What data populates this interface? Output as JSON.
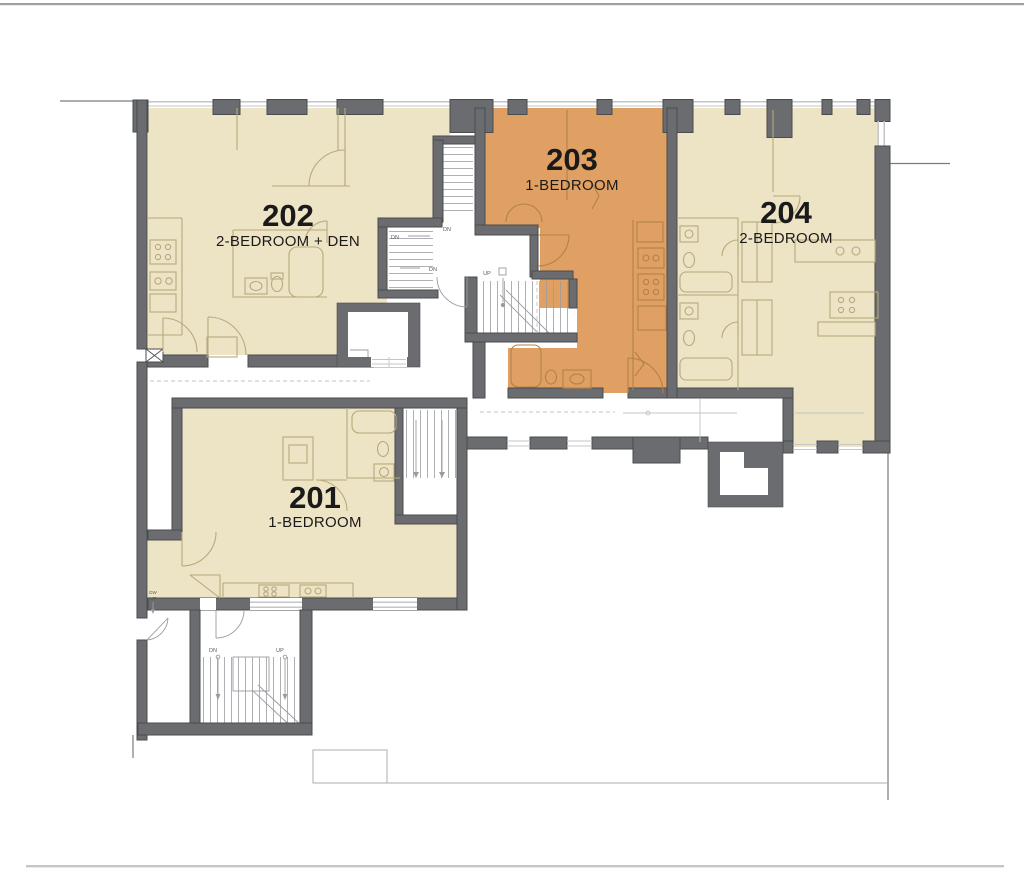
{
  "plan": {
    "units": [
      {
        "number": "201",
        "type": "1-BEDROOM",
        "highlighted": false
      },
      {
        "number": "202",
        "type": "2-BEDROOM + DEN",
        "highlighted": false
      },
      {
        "number": "203",
        "type": "1-BEDROOM",
        "highlighted": true
      },
      {
        "number": "204",
        "type": "2-BEDROOM",
        "highlighted": false
      }
    ],
    "stair_labels": {
      "up": "UP",
      "down": "DN"
    },
    "annotations": {
      "note_top": "DW",
      "note_bottom": "UF"
    },
    "colors": {
      "unit": "#EDE3C5",
      "highlight": "#E1A063",
      "wall": "#6B6C6F",
      "wallstroke": "#4A4B4D",
      "fixture": "#B7AA7D",
      "fixture2": "#B08248",
      "core": "#9A9CA0",
      "windowline": "#C3C5C7",
      "boundary": "#7A7C7F",
      "boundarylight": "#ABADAF",
      "text": "#1A1A1A",
      "stairtext": "#5A5B5E"
    }
  }
}
